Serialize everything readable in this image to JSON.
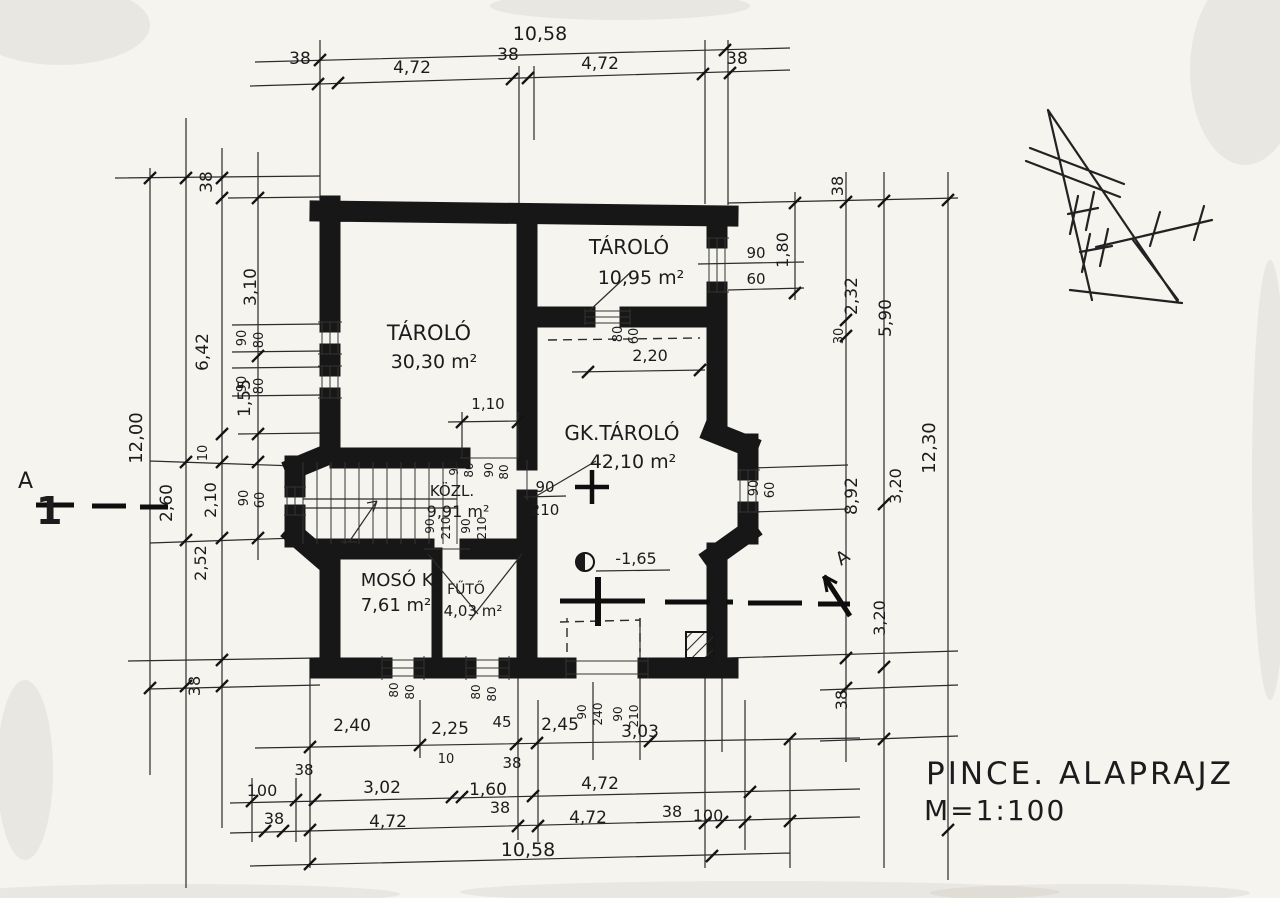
{
  "drawing": {
    "title": "PINCE. ALAPRAJZ",
    "scale": "M=1:100",
    "section_label_left": "A",
    "section_number": "1",
    "section_label_right": "A",
    "level_mark": "-1,65"
  },
  "rooms": [
    {
      "name": "TÁROLÓ",
      "area": "30,30 m²"
    },
    {
      "name": "TÁROLÓ",
      "area": "10,95 m²"
    },
    {
      "name": "GK.TÁROLÓ",
      "area": "42,10 m²"
    },
    {
      "name": "KÖZL.",
      "area": "9,91 m²"
    },
    {
      "name": "MOSÓ K.",
      "area": "7,61 m²"
    },
    {
      "name": "FŰTŐ",
      "area": "4,03 m²"
    }
  ],
  "dimensions": {
    "top": {
      "total": "10,58",
      "segments": [
        "38",
        "4,72",
        "38",
        "4,72",
        "38"
      ]
    },
    "bottom": {
      "row1": [
        "2,40",
        "2,25",
        "45",
        "2,45",
        "3,03"
      ],
      "row1_wall": "38",
      "row2": [
        "100",
        "38",
        "3,02",
        "10",
        "1,60",
        "4,72"
      ],
      "row3": [
        "38",
        "4,72",
        "38",
        "4,72",
        "38",
        "100"
      ],
      "total": "10,58"
    },
    "left": [
      "38",
      "3,10",
      "6,42",
      "1,55",
      "12,00",
      "2,60",
      "10",
      "2,10",
      "2,52",
      "38"
    ],
    "right": [
      "38",
      "1,80",
      "2,32",
      "30",
      "5,90",
      "12,30",
      "8,92",
      "3,20",
      "3,20",
      "38"
    ],
    "interior": {
      "stair_opening": "1,10",
      "storage_wall": "2,20"
    }
  },
  "openings": {
    "west_window_1": [
      "90",
      "80"
    ],
    "west_window_2": [
      "90",
      "80"
    ],
    "west_bay_window": [
      "90",
      "60"
    ],
    "east_window": [
      "90",
      "60"
    ],
    "east_bay_window": [
      "90",
      "60"
    ],
    "storage_hatch": [
      "80",
      "60"
    ],
    "door_gk": [
      "90",
      "210"
    ],
    "kozl_door_1": [
      "90",
      "210"
    ],
    "kozl_door_2": [
      "90",
      "210"
    ],
    "kozl_lintel_1": [
      "90",
      "80"
    ],
    "kozl_lintel_2": [
      "90",
      "80"
    ],
    "south_window_1": [
      "80",
      "80"
    ],
    "south_window_2": [
      "80",
      "80"
    ],
    "south_door_1": [
      "90",
      "240"
    ],
    "south_door_2": [
      "90",
      "210"
    ]
  }
}
